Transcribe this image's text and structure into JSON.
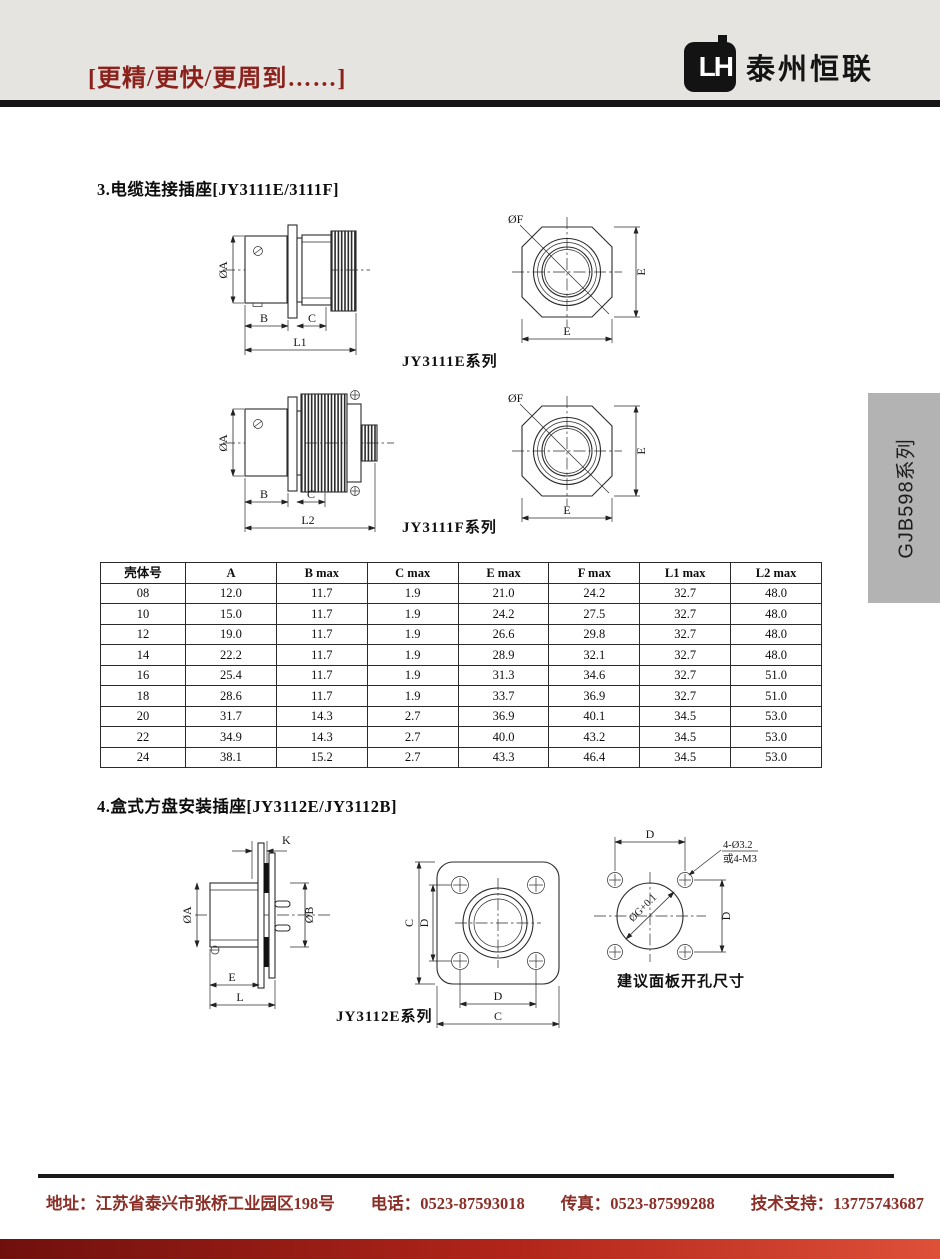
{
  "header": {
    "slogan": "[更精/更快/更周到……]",
    "logo_monogram": "LH",
    "brand": "泰州恒联"
  },
  "side_tab": {
    "label": "GJB598系列"
  },
  "section3": {
    "title": "3.电缆连接插座[JY3111E/3111F]",
    "figure1_caption": "JY3111E系列",
    "figure2_caption": "JY3111F系列"
  },
  "section4": {
    "title": "4.盒式方盘安装插座[JY3112E/JY3112B]",
    "figure_caption": "JY3112E系列",
    "cutout_caption": "建议面板开孔尺寸"
  },
  "dims": {
    "dia_a": "ØA",
    "dia_b": "ØB",
    "dia_f": "ØF",
    "b": "B",
    "c": "C",
    "e": "E",
    "k": "K",
    "l": "L",
    "l1": "L1",
    "l2": "L2",
    "d": "D",
    "dia_g": "ØG+0.1",
    "holes": "4-Ø3.2",
    "holes_alt": "或4-M3"
  },
  "table": {
    "headers": [
      "壳体号",
      "A",
      "B max",
      "C max",
      "E max",
      "F max",
      "L1 max",
      "L2 max"
    ],
    "rows": [
      [
        "08",
        "12.0",
        "11.7",
        "1.9",
        "21.0",
        "24.2",
        "32.7",
        "48.0"
      ],
      [
        "10",
        "15.0",
        "11.7",
        "1.9",
        "24.2",
        "27.5",
        "32.7",
        "48.0"
      ],
      [
        "12",
        "19.0",
        "11.7",
        "1.9",
        "26.6",
        "29.8",
        "32.7",
        "48.0"
      ],
      [
        "14",
        "22.2",
        "11.7",
        "1.9",
        "28.9",
        "32.1",
        "32.7",
        "48.0"
      ],
      [
        "16",
        "25.4",
        "11.7",
        "1.9",
        "31.3",
        "34.6",
        "32.7",
        "51.0"
      ],
      [
        "18",
        "28.6",
        "11.7",
        "1.9",
        "33.7",
        "36.9",
        "32.7",
        "51.0"
      ],
      [
        "20",
        "31.7",
        "14.3",
        "2.7",
        "36.9",
        "40.1",
        "34.5",
        "53.0"
      ],
      [
        "22",
        "34.9",
        "14.3",
        "2.7",
        "40.0",
        "43.2",
        "34.5",
        "53.0"
      ],
      [
        "24",
        "38.1",
        "15.2",
        "2.7",
        "43.3",
        "46.4",
        "34.5",
        "53.0"
      ]
    ]
  },
  "footer": {
    "address": "地址：江苏省泰兴市张桥工业园区198号",
    "phone": "电话：0523-87593018",
    "fax": "传真：0523-87599288",
    "support": "技术支持：13775743687"
  },
  "colors": {
    "header_bg": "#e6e4e1",
    "accent_red": "#8c201a",
    "footer_red": "#8a3028",
    "tab_gray": "#b3b3b3",
    "bar_gradient_left": "#70100d",
    "bar_gradient_right": "#de5038"
  }
}
